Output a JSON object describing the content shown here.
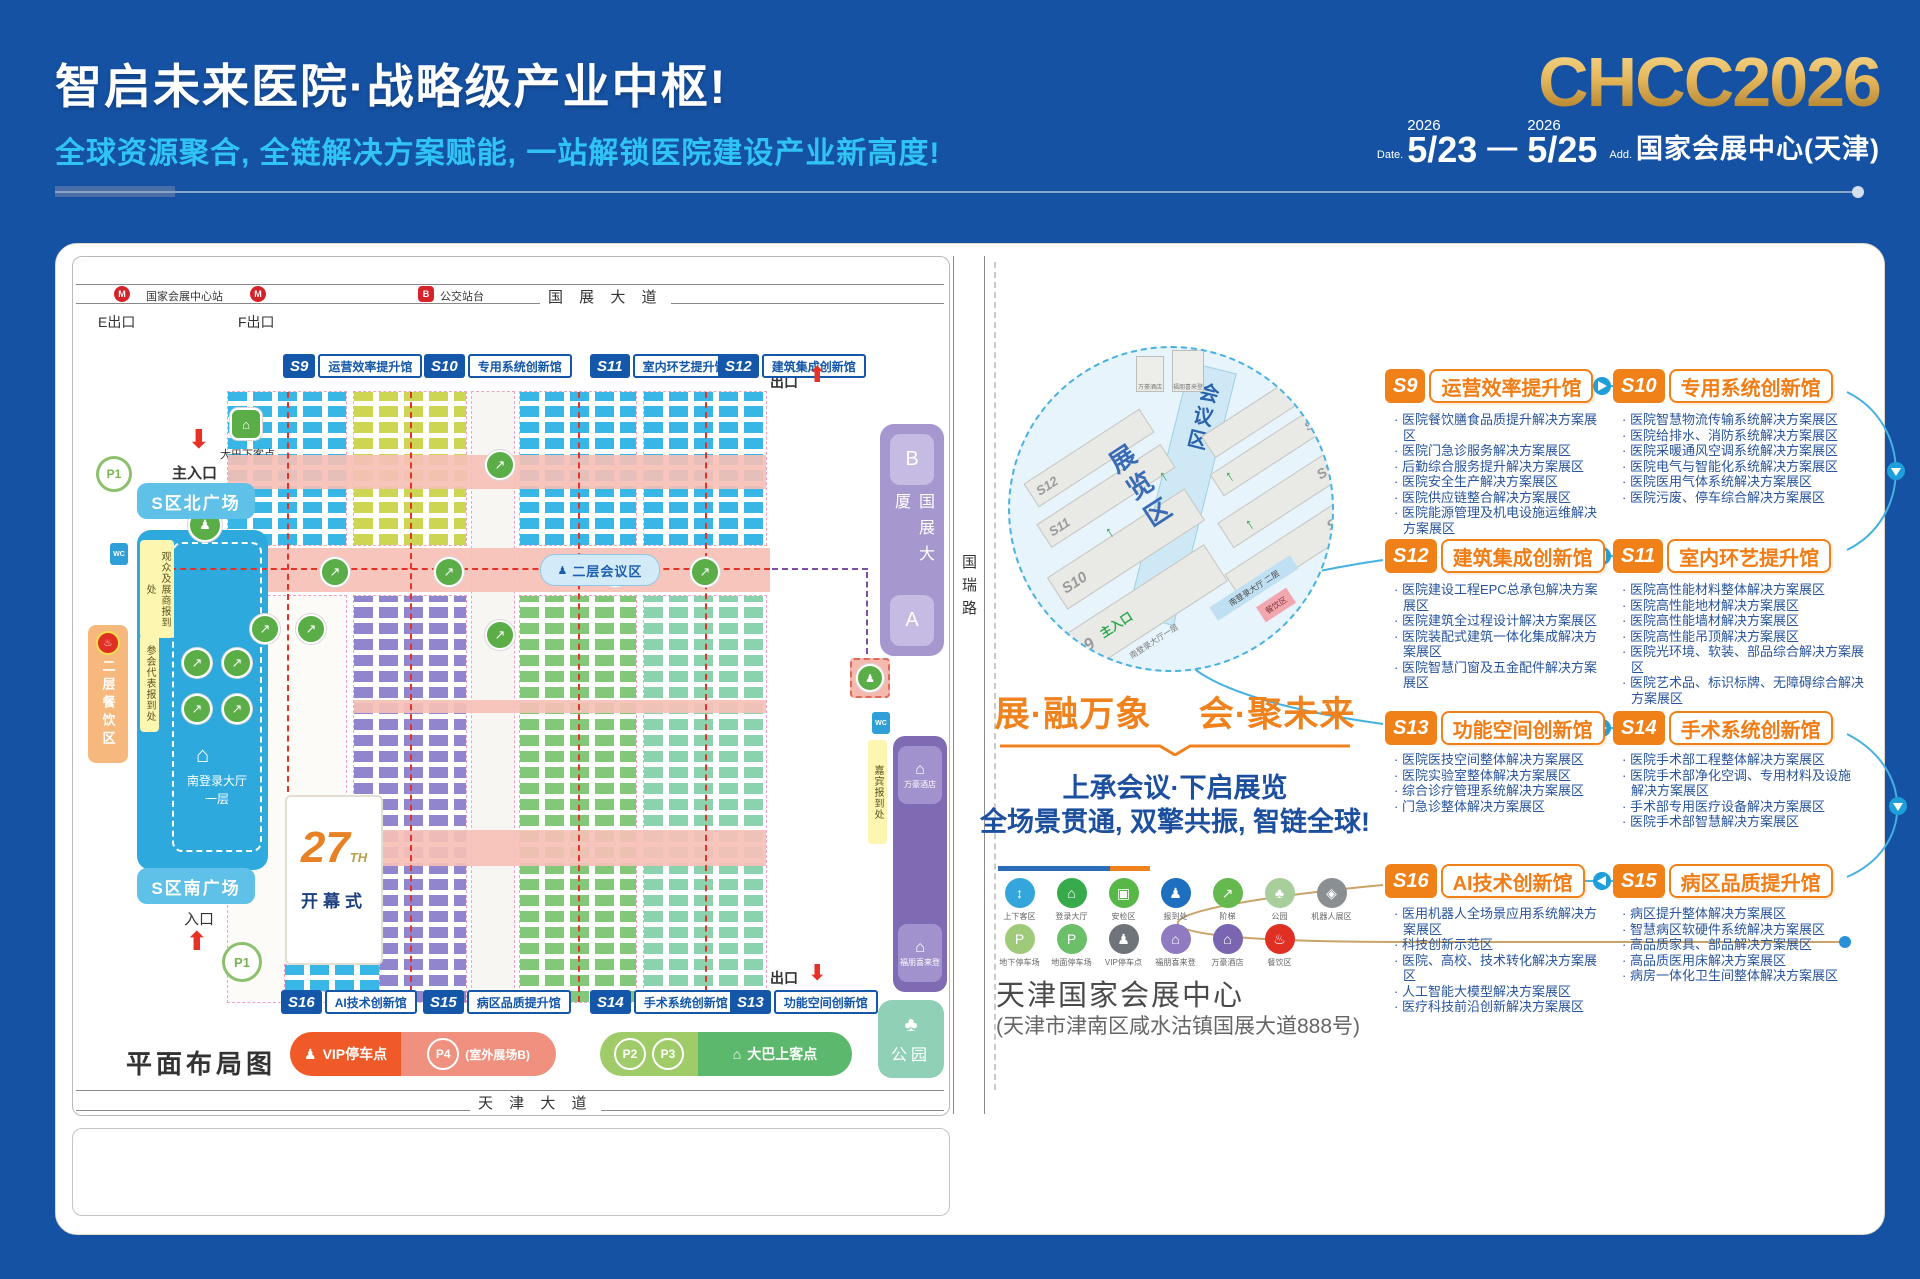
{
  "header": {
    "title": "智启未来医院·战略级产业中枢!",
    "subtitle": "全球资源聚合, 全链解决方案赋能, 一站解锁医院建设产业新高度!",
    "logo": "CHCC2026",
    "date_prefix": "Date.",
    "year1": "2026",
    "day1": "5/23",
    "dash": "—",
    "year2": "2026",
    "day2": "5/25",
    "addr_prefix": "Add.",
    "venue": "国家会展中心(天津)"
  },
  "plan": {
    "top_road": "国 展 大 道",
    "bottom_road": "天 津 大 道",
    "right_road": "国瑞路",
    "station": "国家会展中心站",
    "bus_platform": "公交站台",
    "exit_e": "E出口",
    "exit_f": "F出口",
    "exit": "出口",
    "main_entrance": "主入口",
    "entrance": "入口",
    "bus_drop": "大巴下客点",
    "north_plaza": "S区北广场",
    "south_plaza": "S区南广场",
    "reg_visitor": "观众及展商报到处",
    "reg_delegate": "参会代表报到处",
    "dining2f": "二层餐饮区",
    "login_hall": "南登录大厅",
    "login_floor": "一层",
    "conf_area": "二层会议区",
    "opening_no": "27",
    "opening_th": "TH",
    "opening": "开幕式",
    "tower_b": "B",
    "tower_name": "国展大厦",
    "tower_a": "A",
    "guest_reg": "嘉宾报到处",
    "hotel_marriott": "万豪酒店",
    "hotel_fourpoints": "福朋喜来登",
    "park": "公园",
    "caption": "平面布局图",
    "p1": "P1",
    "p2": "P2",
    "p3": "P3",
    "p4": "P4",
    "vip_parking": "VIP停车点",
    "p4_note": "(室外展场B)",
    "bus_pickup": "大巴上客点",
    "wc": "WC",
    "halls_top": [
      {
        "id": "S9",
        "name": "运营效率提升馆"
      },
      {
        "id": "S10",
        "name": "专用系统创新馆"
      },
      {
        "id": "S11",
        "name": "室内环艺提升馆"
      },
      {
        "id": "S12",
        "name": "建筑集成创新馆"
      }
    ],
    "halls_bottom": [
      {
        "id": "S16",
        "name": "AI技术创新馆"
      },
      {
        "id": "S15",
        "name": "病区品质提升馆"
      },
      {
        "id": "S14",
        "name": "手术系统创新馆"
      },
      {
        "id": "S13",
        "name": "功能空间创新馆"
      }
    ]
  },
  "right": {
    "circle": {
      "expo": "展览区",
      "conf": "会议区",
      "login2": "南登录大厅 二层",
      "login1": "南登录大厅一层",
      "main_entrance": "主入口",
      "dining": "餐饮区",
      "hotel1": "万豪酒店",
      "hotel2": "福朋喜来登",
      "halls_left": [
        "S12",
        "S11",
        "S10",
        "S9"
      ],
      "halls_right": [
        "S13",
        "S14",
        "S15",
        "S16"
      ]
    },
    "slogan_left": "展·融万象",
    "slogan_right": "会·聚未来",
    "sub1": "上承会议·下启展览",
    "sub2": "全场景贯通, 双擎共振, 智链全球!",
    "legend1": [
      "上下客区",
      "登录大厅",
      "安检区",
      "报到处",
      "阶梯",
      "公园",
      "机器人展区"
    ],
    "legend2": [
      "地下停车场",
      "地面停车场",
      "VIP停车点",
      "福朋喜来登",
      "万豪酒店",
      "餐饮区"
    ],
    "venue_name": "天津国家会展中心",
    "venue_addr": "(天津市津南区咸水沽镇国展大道888号)",
    "sections": [
      {
        "id": "S9",
        "name": "运营效率提升馆",
        "items": [
          "医院餐饮膳食品质提升解决方案展区",
          "医院门急诊服务解决方案展区",
          "后勤综合服务提升解决方案展区",
          "医院安全生产解决方案展区",
          "医院供应链整合解决方案展区",
          "医院能源管理及机电设施运维解决方案展区"
        ]
      },
      {
        "id": "S10",
        "name": "专用系统创新馆",
        "items": [
          "医院智慧物流传输系统解决方案展区",
          "医院给排水、消防系统解决方案展区",
          "医院采暖通风空调系统解决方案展区",
          "医院电气与智能化系统解决方案展区",
          "医院医用气体系统解决方案展区",
          "医院污废、停车综合解决方案展区"
        ]
      },
      {
        "id": "S12",
        "name": "建筑集成创新馆",
        "items": [
          "医院建设工程EPC总承包解决方案展区",
          "医院建筑全过程设计解决方案展区",
          "医院装配式建筑一体化集成解决方案展区",
          "医院智慧门窗及五金配件解决方案展区"
        ]
      },
      {
        "id": "S11",
        "name": "室内环艺提升馆",
        "items": [
          "医院高性能材料整体解决方案展区",
          "医院高性能地材解决方案展区",
          "医院高性能墙材解决方案展区",
          "医院高性能吊顶解决方案展区",
          "医院光环境、软装、部品综合解决方案展区",
          "医院艺术品、标识标牌、无障碍综合解决方案展区"
        ]
      },
      {
        "id": "S13",
        "name": "功能空间创新馆",
        "items": [
          "医院医技空间整体解决方案展区",
          "医院实验室整体解决方案展区",
          "综合诊疗管理系统解决方案展区",
          "门急诊整体解决方案展区"
        ]
      },
      {
        "id": "S14",
        "name": "手术系统创新馆",
        "items": [
          "医院手术部工程整体解决方案展区",
          "医院手术部净化空调、专用材料及设施解决方案展区",
          "手术部专用医疗设备解决方案展区",
          "医院手术部智慧解决方案展区"
        ]
      },
      {
        "id": "S16",
        "name": "AI技术创新馆",
        "items": [
          "医用机器人全场景应用系统解决方案展区",
          "科技创新示范区",
          "医院、高校、技术转化解决方案展区",
          "人工智能大模型解决方案展区",
          "医疗科技前沿创新解决方案展区"
        ]
      },
      {
        "id": "S15",
        "name": "病区品质提升馆",
        "items": [
          "病区提升整体解决方案展区",
          "智慧病区软硬件系统解决方案展区",
          "高品质家具、部品解决方案展区",
          "高品质医用床解决方案展区",
          "病房一体化卫生间整体解决方案展区"
        ]
      }
    ]
  }
}
